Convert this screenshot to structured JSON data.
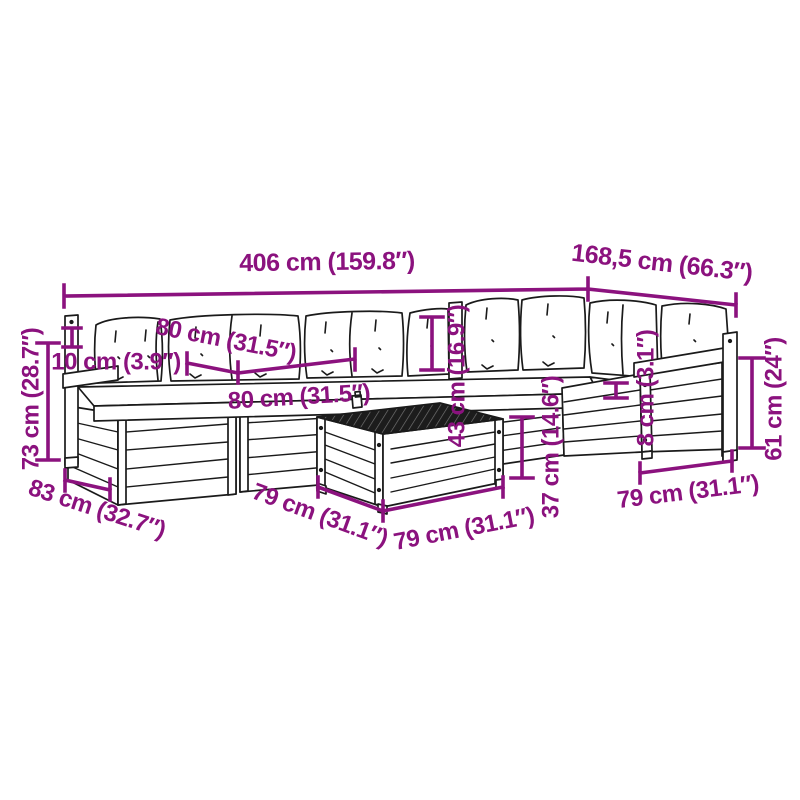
{
  "colors": {
    "dimension": "#8B127E",
    "drawing": "#1a1a1a",
    "background": "#ffffff",
    "tabletop_fill": "#1c1c1c"
  },
  "dimensions": [
    {
      "id": "overall-width",
      "label": "406 cm (159.8″)"
    },
    {
      "id": "side-section-width",
      "label": "168,5 cm (66.3″)"
    },
    {
      "id": "total-height",
      "label": "73 cm (28.7″)"
    },
    {
      "id": "armrest-rise",
      "label": "10 cm (3.9″)"
    },
    {
      "id": "cushion-width-left",
      "label": "80 cm (31.5″)"
    },
    {
      "id": "cushion-width-front",
      "label": "80 cm (31.5″)"
    },
    {
      "id": "backrest-height",
      "label": "43 cm (16.9″)"
    },
    {
      "id": "seat-height",
      "label": "37 cm (14.6″)"
    },
    {
      "id": "cushion-thickness",
      "label": "8 cm (3.1″)"
    },
    {
      "id": "armrest-height",
      "label": "61 cm (24″)"
    },
    {
      "id": "module-depth-left",
      "label": "83 cm (32.7″)"
    },
    {
      "id": "table-depth",
      "label": "79 cm (31.1″)"
    },
    {
      "id": "table-width",
      "label": "79 cm (31.1″)"
    },
    {
      "id": "module-width-right",
      "label": "79 cm (31.1″)"
    }
  ]
}
